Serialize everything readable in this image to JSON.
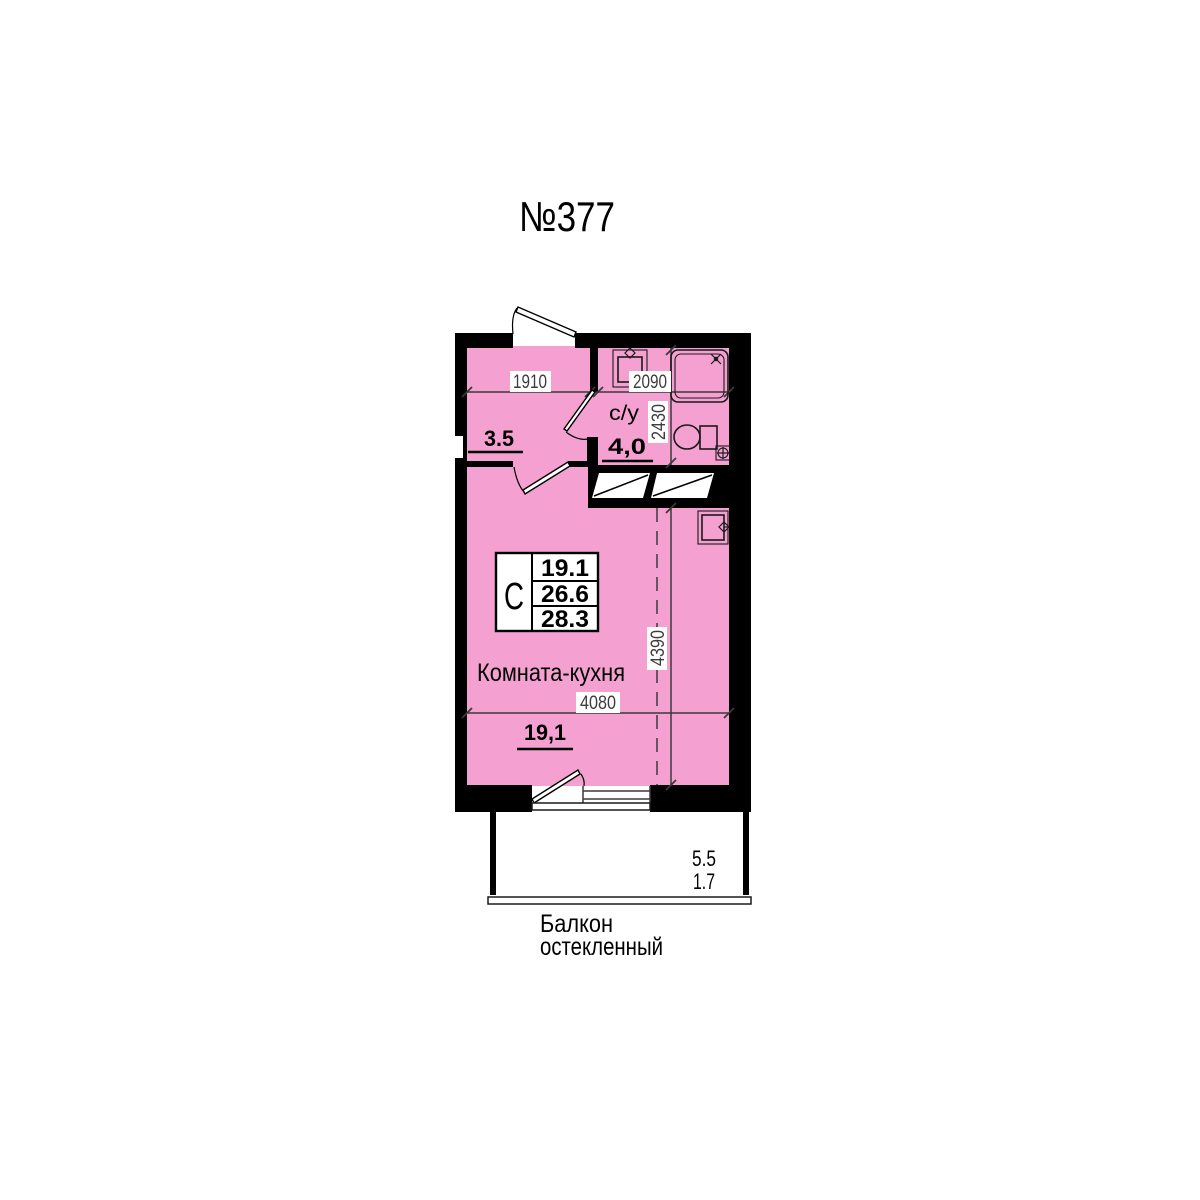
{
  "title": "№377",
  "colors": {
    "room_fill": "#F4A1D2",
    "wall": "#000000",
    "dimension_text": "#3D3D3D",
    "line": "#3A3A3A"
  },
  "plan": {
    "hallway": {
      "width_mm": "1910",
      "area": "3.5"
    },
    "bathroom": {
      "name": "с/у",
      "area": "4,0",
      "width_mm": "2090",
      "depth_mm": "2430"
    },
    "living_room": {
      "name": "Комната-кухня",
      "area": "19,1",
      "width_mm": "4080",
      "depth_mm": "4390"
    },
    "info_table": {
      "type": "С",
      "living_area": "19.1",
      "area_without_balcony": "26.6",
      "total_area": "28.3"
    },
    "balcony": {
      "area_full": "5.5",
      "area_counted": "1.7",
      "name_line1": "Балкон",
      "name_line2": "остекленный"
    },
    "fixtures": [
      "washbasin",
      "shower-tray",
      "toilet",
      "water-valve",
      "kitchen-sink",
      "vent-shaft",
      "entrance-door",
      "interior-door",
      "bathroom-door",
      "balcony-door",
      "window",
      "balcony-glazing"
    ]
  }
}
